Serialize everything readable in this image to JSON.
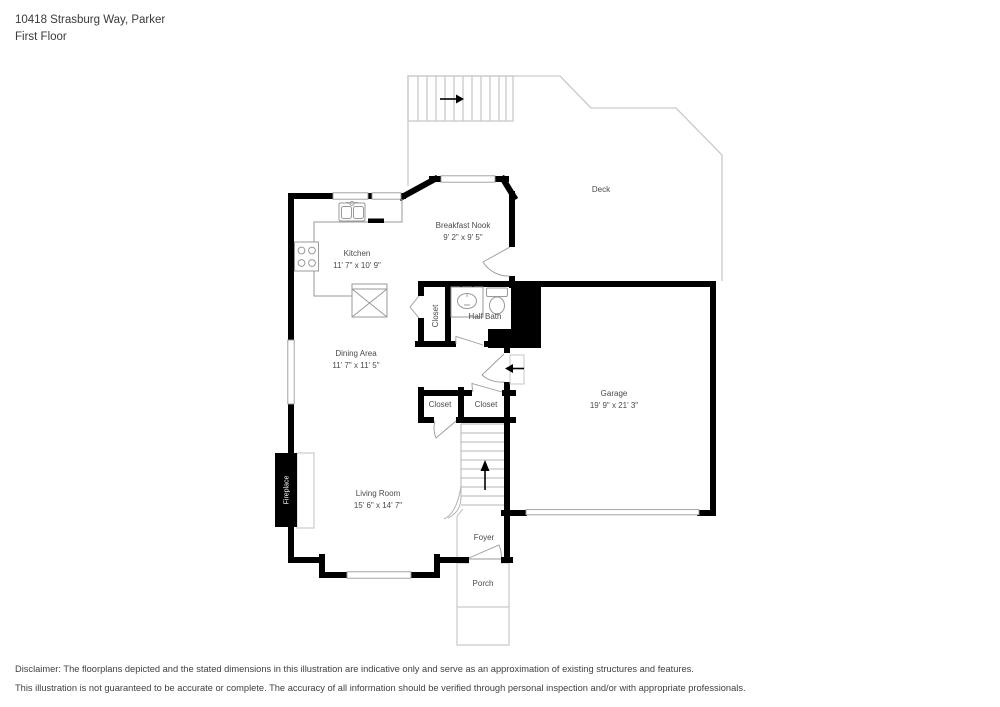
{
  "header": {
    "address": "10418 Strasburg Way, Parker",
    "floor": "First Floor"
  },
  "rooms": {
    "deck": {
      "label": "Deck"
    },
    "breakfast_nook": {
      "label": "Breakfast Nook",
      "dims": "9' 2\" x 9' 5\""
    },
    "kitchen": {
      "label": "Kitchen",
      "dims": "11' 7\" x 10' 9\""
    },
    "half_bath": {
      "label": "Half Bath"
    },
    "hall_closet": {
      "label": "Closet"
    },
    "dining_area": {
      "label": "Dining Area",
      "dims": "11' 7\" x 11' 5\""
    },
    "garage": {
      "label": "Garage",
      "dims": "19' 9\" x 21' 3\""
    },
    "closet_left": {
      "label": "Closet"
    },
    "closet_right": {
      "label": "Closet"
    },
    "living_room": {
      "label": "Living Room",
      "dims": "15' 6\" x 14' 7\""
    },
    "fireplace": {
      "label": "Fireplace"
    },
    "foyer": {
      "label": "Foyer"
    },
    "porch": {
      "label": "Porch"
    }
  },
  "icons": {
    "deck_stairs_arrow": "arrow-right",
    "garage_entry_arrow": "arrow-left",
    "main_stairs_arrow": "arrow-up"
  },
  "colors": {
    "wall": "#000000",
    "deck_outline": "#c9c9c9",
    "fixture_outline": "#9a9a9a",
    "room_label": "#4a4a4a"
  },
  "footer": {
    "line1": "Disclaimer: The floorplans depicted and the stated dimensions in this illustration are indicative only and serve as an approximation of existing structures and features.",
    "line2": "This illustration is not guaranteed to be accurate or complete. The accuracy of all information should be verified through personal inspection and/or with appropriate professionals."
  }
}
